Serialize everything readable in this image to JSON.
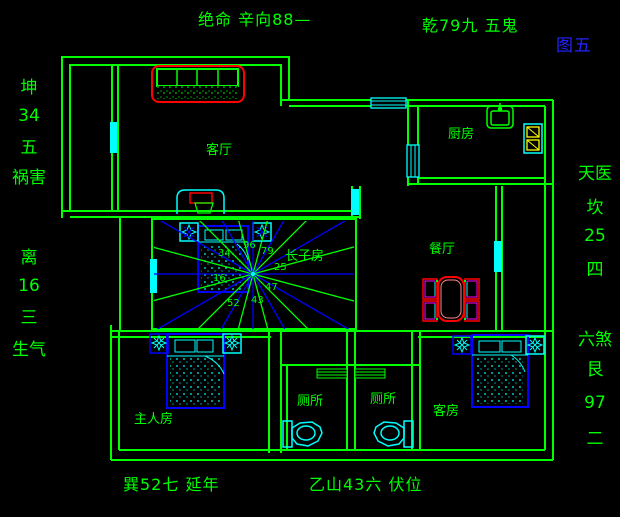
{
  "figure_label": "图五",
  "annotations": {
    "top_center": "绝命 辛向88—",
    "top_right": "乾79九 五鬼",
    "left": [
      "坤",
      "34",
      "五",
      "祸害",
      "离",
      "16",
      "三",
      "生气"
    ],
    "right": [
      "天医",
      "坎",
      "25",
      "四",
      "六煞",
      "艮",
      "97",
      "二"
    ],
    "bottom_left": "巽52七 延年",
    "bottom_center": "乙山43六 伏位"
  },
  "rooms": {
    "living": "客厅",
    "kitchen": "厨房",
    "dining": "餐厅",
    "eldest_son": "长子房",
    "master": "主人房",
    "toilet_left": "厕所",
    "toilet_right": "厕所",
    "guest": "客房"
  },
  "radial": {
    "numbers": [
      {
        "value": "96"
      },
      {
        "value": "79"
      },
      {
        "value": "25"
      },
      {
        "value": "47"
      },
      {
        "value": "43"
      },
      {
        "value": "52"
      },
      {
        "value": "34"
      },
      {
        "value": "16"
      }
    ],
    "center": [
      253,
      274
    ],
    "count": 24,
    "step_deg": 15,
    "length": 170,
    "colors": [
      "#0000ff",
      "#00ff00"
    ]
  },
  "colors": {
    "background": "#000000",
    "wall": "#00ff00",
    "fixture": "#00ffff",
    "accent_red": "#ff0000",
    "bed_blue": "#0000ff",
    "text": "#00ff00",
    "figure_label": "#0000ff",
    "burner": "#ffff00",
    "chair": "#ff00ff"
  }
}
